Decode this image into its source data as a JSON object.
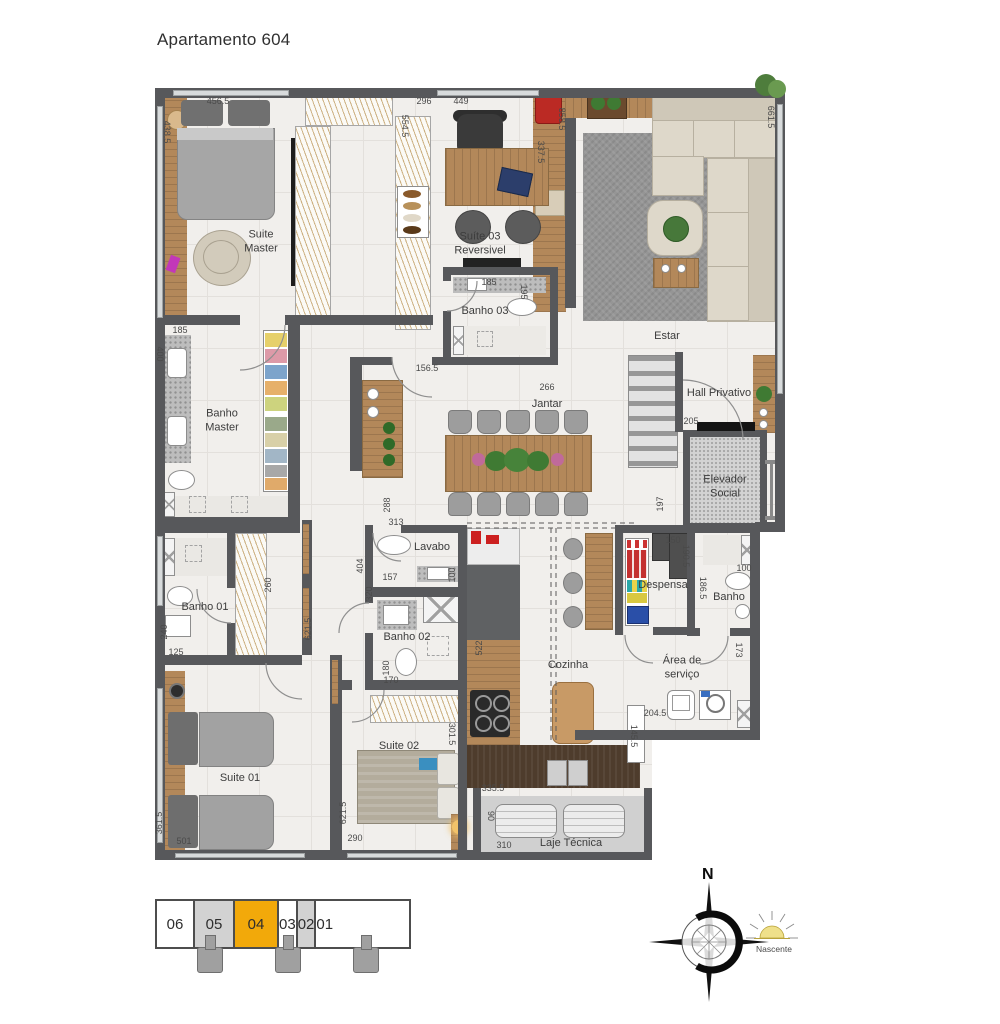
{
  "title": "Apartamento 604",
  "plan": {
    "rooms": [
      {
        "label": "Suite\nMaster",
        "x": 106,
        "y": 154
      },
      {
        "label": "Suíte 03\nReversivel",
        "x": 325,
        "y": 156
      },
      {
        "label": "Banho 03",
        "x": 330,
        "y": 224
      },
      {
        "label": "Estar",
        "x": 512,
        "y": 249
      },
      {
        "label": "Hall Privativo",
        "x": 564,
        "y": 306
      },
      {
        "label": "Elevador\nSocial",
        "x": 570,
        "y": 399
      },
      {
        "label": "Banho\nMaster",
        "x": 67,
        "y": 333
      },
      {
        "label": "Jantar",
        "x": 392,
        "y": 317
      },
      {
        "label": "Lavabo",
        "x": 277,
        "y": 460
      },
      {
        "label": "Banho 02",
        "x": 252,
        "y": 550
      },
      {
        "label": "Banho 01",
        "x": 50,
        "y": 520
      },
      {
        "label": "Suite 01",
        "x": 85,
        "y": 691
      },
      {
        "label": "Suite 02",
        "x": 244,
        "y": 659
      },
      {
        "label": "Cozinha",
        "x": 413,
        "y": 578
      },
      {
        "label": "Despensa",
        "x": 508,
        "y": 498
      },
      {
        "label": "Banho",
        "x": 574,
        "y": 510
      },
      {
        "label": "Área de\nserviço",
        "x": 527,
        "y": 580
      },
      {
        "label": "Laje Técnica",
        "x": 416,
        "y": 756
      }
    ],
    "dimensions": [
      {
        "t": "456.5",
        "x": 63,
        "y": 13
      },
      {
        "t": "438.5",
        "x": 12,
        "y": 44,
        "r": 90
      },
      {
        "t": "296",
        "x": 269,
        "y": 13
      },
      {
        "t": "554.5",
        "x": 250,
        "y": 38,
        "r": 90
      },
      {
        "t": "449",
        "x": 306,
        "y": 13
      },
      {
        "t": "337.5",
        "x": 386,
        "y": 64,
        "r": 90
      },
      {
        "t": "858.5",
        "x": 407,
        "y": 31,
        "r": 90
      },
      {
        "t": "661.5",
        "x": 616,
        "y": 29,
        "r": 90
      },
      {
        "t": "185",
        "x": 25,
        "y": 242
      },
      {
        "t": "400",
        "x": 5,
        "y": 266,
        "r": 90
      },
      {
        "t": "185",
        "x": 334,
        "y": 194
      },
      {
        "t": "195",
        "x": 369,
        "y": 204,
        "r": 90
      },
      {
        "t": "156.5",
        "x": 272,
        "y": 280
      },
      {
        "t": "266",
        "x": 392,
        "y": 299
      },
      {
        "t": "205",
        "x": 536,
        "y": 333
      },
      {
        "t": "197",
        "x": 505,
        "y": 416,
        "r": -90
      },
      {
        "t": "404",
        "x": 205,
        "y": 478,
        "r": -90
      },
      {
        "t": "288",
        "x": 232,
        "y": 417,
        "r": -90
      },
      {
        "t": "313",
        "x": 241,
        "y": 434
      },
      {
        "t": "320",
        "x": 214,
        "y": 506,
        "r": -90
      },
      {
        "t": "157",
        "x": 235,
        "y": 489
      },
      {
        "t": "100",
        "x": 297,
        "y": 487,
        "r": -90
      },
      {
        "t": "260",
        "x": 113,
        "y": 497,
        "r": -90
      },
      {
        "t": "240",
        "x": 9,
        "y": 544,
        "r": -90
      },
      {
        "t": "125",
        "x": 21,
        "y": 564
      },
      {
        "t": "621.5",
        "x": 153,
        "y": 541,
        "r": -90
      },
      {
        "t": "180",
        "x": 231,
        "y": 580,
        "r": -90
      },
      {
        "t": "170",
        "x": 236,
        "y": 592
      },
      {
        "t": "150",
        "x": 518,
        "y": 452
      },
      {
        "t": "190.5",
        "x": 531,
        "y": 468,
        "r": 90
      },
      {
        "t": "186.5",
        "x": 548,
        "y": 500,
        "r": 90
      },
      {
        "t": "100",
        "x": 589,
        "y": 480
      },
      {
        "t": "522",
        "x": 324,
        "y": 560,
        "r": -90
      },
      {
        "t": "173",
        "x": 584,
        "y": 562,
        "r": 90
      },
      {
        "t": "204.5",
        "x": 500,
        "y": 625
      },
      {
        "t": "145.5",
        "x": 479,
        "y": 648,
        "r": 90
      },
      {
        "t": "335.5",
        "x": 338,
        "y": 700
      },
      {
        "t": "90",
        "x": 336,
        "y": 728,
        "r": 90
      },
      {
        "t": "310",
        "x": 349,
        "y": 757
      },
      {
        "t": "621.5",
        "x": 188,
        "y": 725,
        "r": -90
      },
      {
        "t": "290",
        "x": 200,
        "y": 750
      },
      {
        "t": "301.5",
        "x": 297,
        "y": 646,
        "r": 90
      },
      {
        "t": "361.5",
        "x": 4,
        "y": 735,
        "r": -90
      },
      {
        "t": "501",
        "x": 29,
        "y": 753
      }
    ]
  },
  "unit_selector": {
    "cells": [
      {
        "number": "06",
        "state": "default"
      },
      {
        "number": "05",
        "state": "shaded"
      },
      {
        "number": "04",
        "state": "selected"
      },
      {
        "number": "03",
        "state": "default"
      },
      {
        "number": "02",
        "state": "shaded"
      },
      {
        "number": "01",
        "state": "default"
      }
    ],
    "selected_color": "#F2A90A"
  },
  "compass": {
    "north": "N",
    "east_label": "Nascente"
  }
}
